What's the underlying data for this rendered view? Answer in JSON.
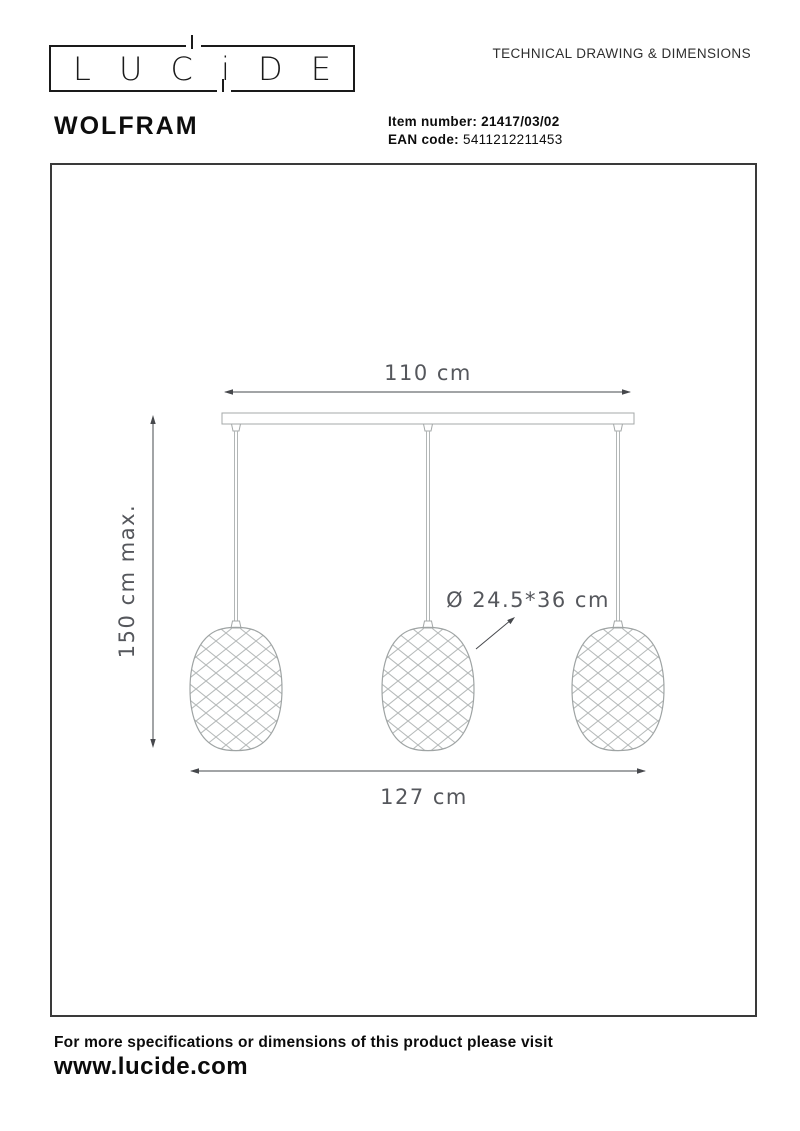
{
  "header": {
    "logo_letters": [
      "L",
      "U",
      "C",
      "i",
      "D",
      "E"
    ],
    "page_title": "TECHNICAL DRAWING & DIMENSIONS"
  },
  "product": {
    "name": "WOLFRAM",
    "item_number_label": "Item number:",
    "item_number_value": "21417/03/02",
    "ean_label": "EAN code:",
    "ean_value": "5411212211453"
  },
  "drawing": {
    "dim_top_width": "110 cm",
    "dim_height": "150 cm max.",
    "dim_shade_size": "Ø 24.5*36 cm",
    "dim_bottom_width": "127 cm",
    "fixture_description": "linear-pendant-3-wire-cage-shades"
  },
  "footer": {
    "line1": "For more specifications or dimensions of this product please visit",
    "line2": "www.lucide.com"
  },
  "colors": {
    "frame_border": "#3a3a3a",
    "drawing_outline": "#9fa4a4",
    "lattice": "#b6baba",
    "dimension_line": "#46484c",
    "dimension_text": "#55575c",
    "text": "#111111",
    "background": "#ffffff"
  }
}
